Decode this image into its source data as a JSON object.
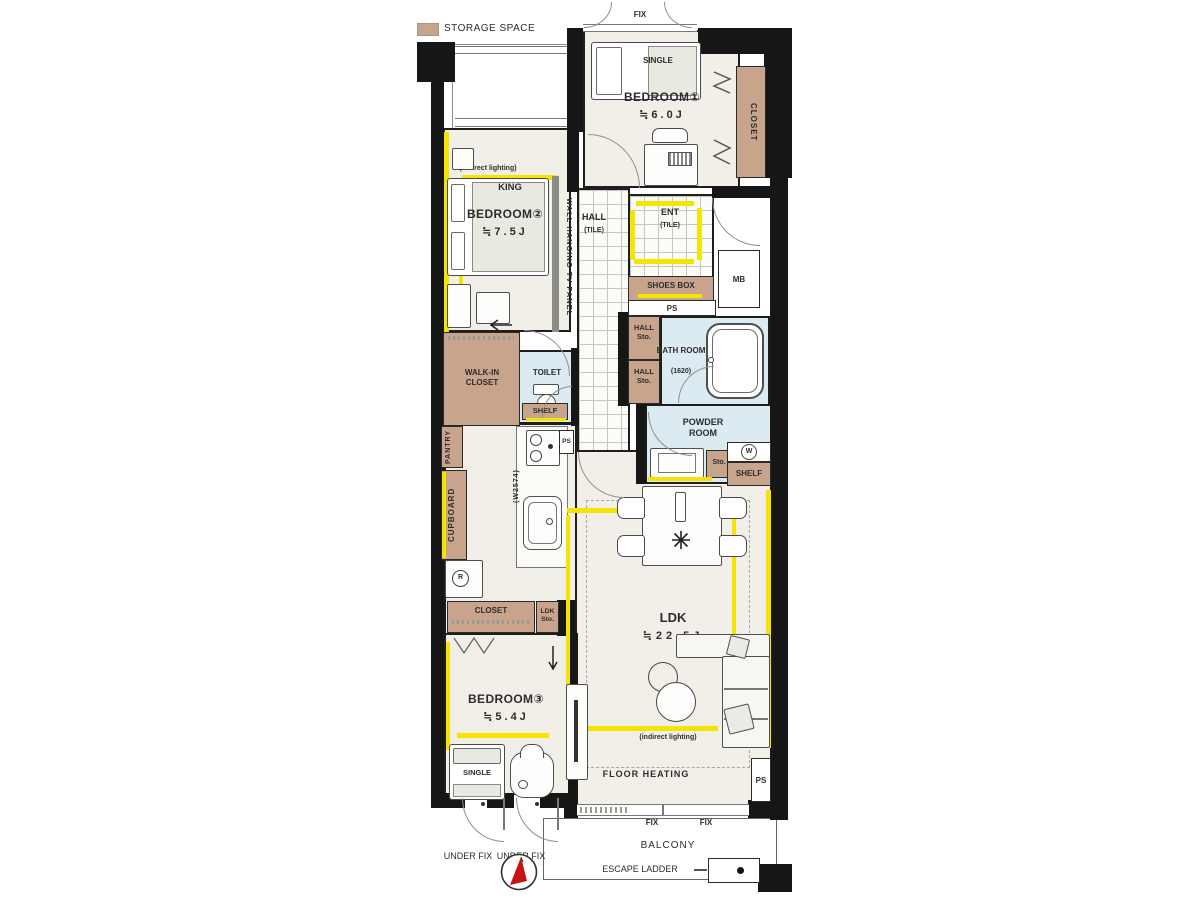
{
  "legend": {
    "storage_space": "STORAGE SPACE"
  },
  "colors": {
    "storage_tan": "#c9a48d",
    "wet_blue": "#dcebf1",
    "accent_yellow": "#f4e400",
    "wall_black": "#161616",
    "floor_beige": "#f1efe8"
  },
  "bedroom1": {
    "name": "BEDROOM①",
    "area": "≒6.0J",
    "bed": "SINGLE",
    "closet": "CLOSET",
    "window": "FIX"
  },
  "bedroom2": {
    "name": "BEDROOM②",
    "area": "≒7.5J",
    "bed": "KING",
    "indirect_lighting": "(indirect lighting)",
    "tv_panel": "WALL HANGING TV PANEL"
  },
  "bedroom3": {
    "name": "BEDROOM③",
    "area": "≒5.4J",
    "bed": "SINGLE"
  },
  "entrance": {
    "hall": "HALL",
    "hall_tile": "(TILE)",
    "ent": "ENT",
    "ent_tile": "(TILE)",
    "shoes_box": "SHOES BOX",
    "ps": "PS",
    "mb": "MB"
  },
  "sanitary": {
    "hall_sto_upper": "HALL Sto.",
    "hall_sto_lower": "HALL Sto.",
    "bath_name": "BATH ROOM",
    "bath_size": "(1620)",
    "powder_room": "POWDER ROOM",
    "sto": "Sto.",
    "washer_mark": "W",
    "shelf": "SHELF",
    "toilet": "TOILET",
    "toilet_shelf": "SHELF"
  },
  "storage": {
    "walk_in_closet": "WALK-IN CLOSET",
    "pantry": "PANTRY",
    "cupboard": "CUPBOARD",
    "bedroom3_closet": "CLOSET",
    "ldk_sto": "LDK Sto."
  },
  "kitchen": {
    "width_note": "(W2574)",
    "ps": "PS",
    "fridge_mark": "R"
  },
  "ldk": {
    "name": "LDK",
    "area": "≒22.5J",
    "indirect_lighting": "(indirect lighting)",
    "floor_heating": "FLOOR HEATING",
    "ps": "PS"
  },
  "openings": {
    "fix_left": "FIX",
    "fix_right": "FIX",
    "under_fix_left": "UNDER FIX",
    "under_fix_right": "UNDER FIX"
  },
  "balcony": {
    "name": "BALCONY",
    "escape_ladder": "ESCAPE LADDER"
  }
}
